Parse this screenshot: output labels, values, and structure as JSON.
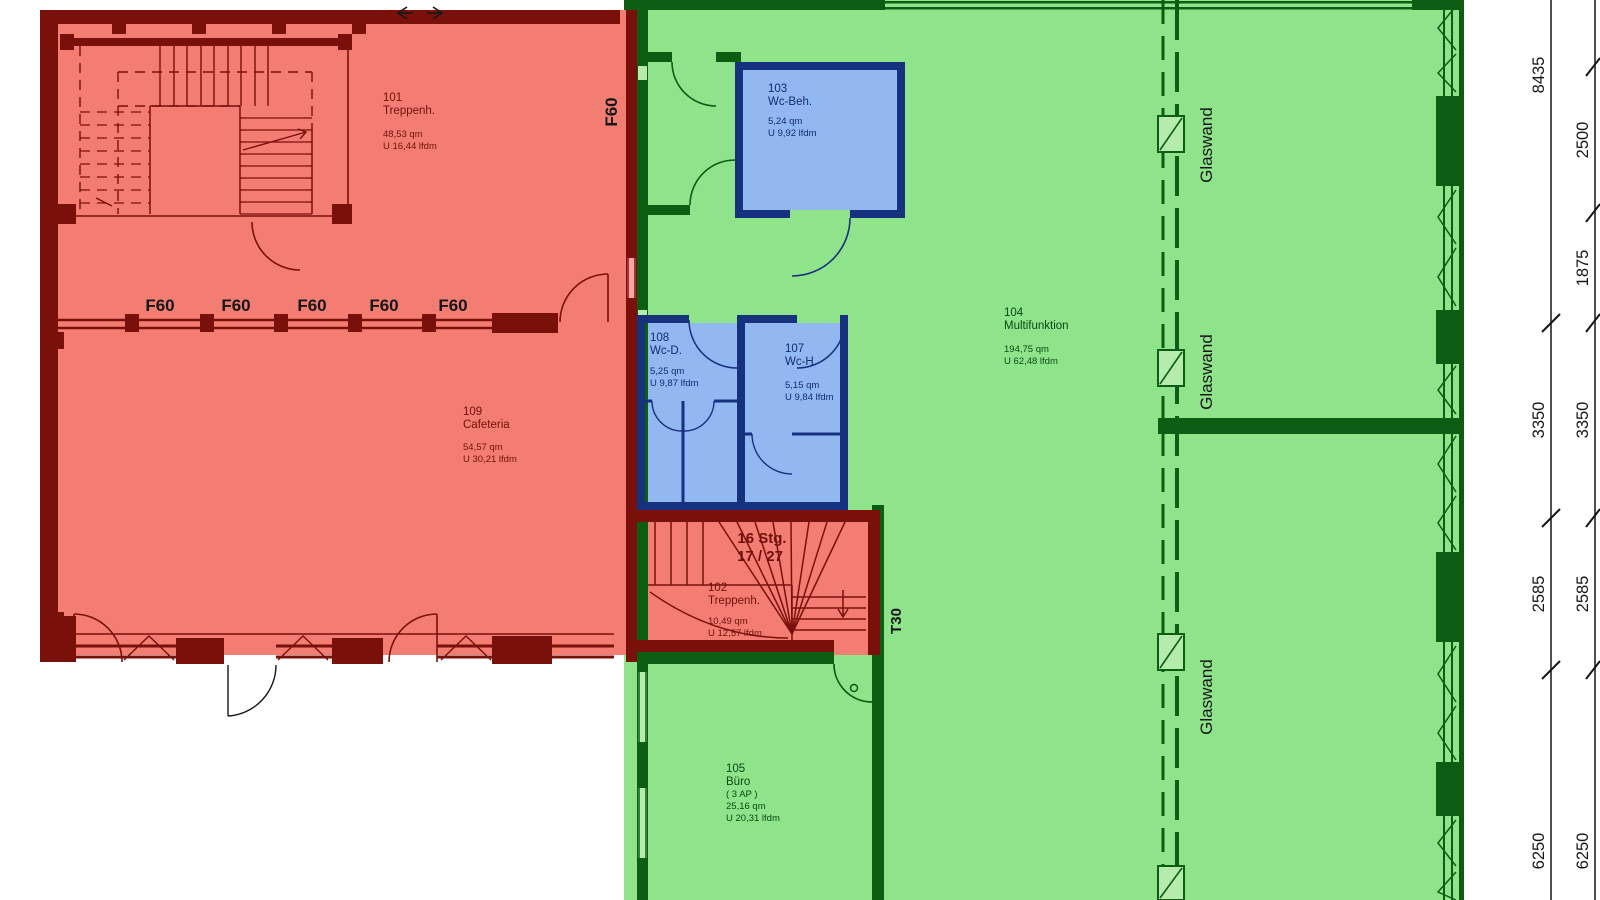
{
  "drawing": {
    "type": "architectural-floor-plan",
    "zones": {
      "red_fill": "#f47d73",
      "red_wall": "#7a100a",
      "green_fill": "#8ee38b",
      "green_wall": "#0c5c12",
      "blue_fill": "#92b8f2",
      "blue_wall": "#16317e"
    }
  },
  "labels": {
    "f60": "F60",
    "t30": "T30",
    "glaswand": "Glaswand"
  },
  "rooms": {
    "r101": {
      "number": "101",
      "name": "Treppenh.",
      "area": "48,53 qm",
      "perimeter": "U 16,44 lfdm"
    },
    "r102": {
      "number": "102",
      "name": "Treppenh.",
      "area": "10,49 qm",
      "perimeter": "U 12,57 lfdm"
    },
    "r103": {
      "number": "103",
      "name": "Wc-Beh.",
      "area": "5,24 qm",
      "perimeter": "U 9,92 lfdm"
    },
    "r104": {
      "number": "104",
      "name": "Multifunktion",
      "area": "194,75 qm",
      "perimeter": "U 62,48 lfdm"
    },
    "r105": {
      "number": "105",
      "name": "Büro",
      "extra": "( 3 AP )",
      "area": "25,16 qm",
      "perimeter": "U 20,31 lfdm"
    },
    "r107": {
      "number": "107",
      "name": "Wc-H.",
      "area": "5,15 qm",
      "perimeter": "U 9,84 lfdm"
    },
    "r108": {
      "number": "108",
      "name": "Wc-D.",
      "area": "5,25 qm",
      "perimeter": "U 9,87 lfdm"
    },
    "r109": {
      "number": "109",
      "name": "Cafeteria",
      "area": "54,57 qm",
      "perimeter": "U 30,21 lfdm"
    }
  },
  "stair": {
    "line1": "16 Stg.",
    "line2": "17 / 27"
  },
  "dims": {
    "inner": [
      "8435",
      "3350",
      "2585",
      "6250"
    ],
    "outer": [
      "2500",
      "1875",
      "3350",
      "2585",
      "6250"
    ]
  }
}
